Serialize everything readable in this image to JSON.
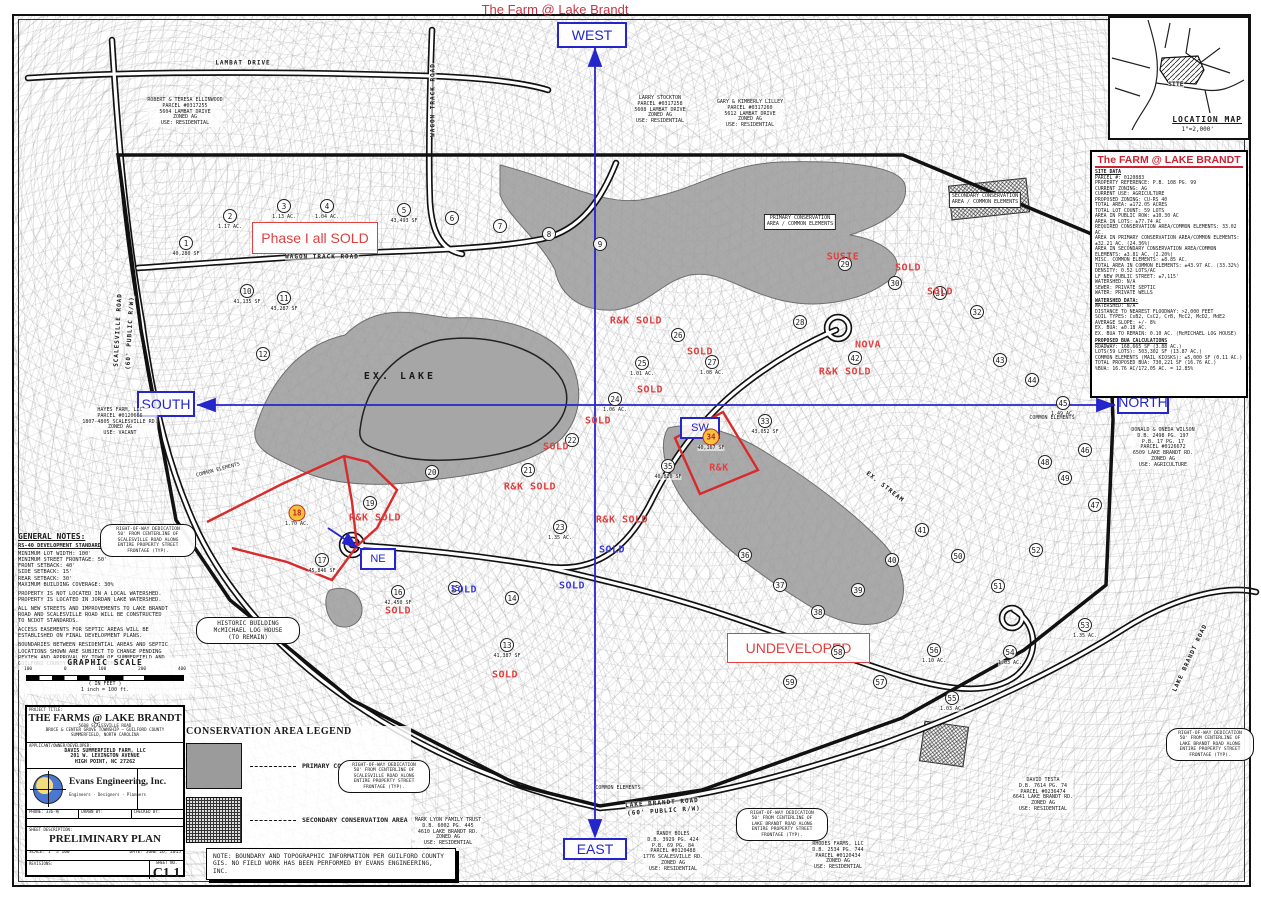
{
  "page_title": "The Farm @ Lake Brandt",
  "colors": {
    "annotation_red": "#e04040",
    "compass_blue": "#2525cc",
    "highlight_orange": "#f6c13d",
    "conservation_gray": "#9b9b9b"
  },
  "compass": {
    "west": "WEST",
    "east": "EAST",
    "south": "SOUTH",
    "north": "NORTH",
    "ne": "NE",
    "sw": "SW"
  },
  "location_map": {
    "site": "SITE",
    "title": "LOCATION MAP",
    "scale": "1\"=2,000'"
  },
  "site_data": {
    "title": "The FARM @ LAKE BRANDT",
    "lines": [
      {
        "t": "SITE DATA",
        "h": true
      },
      {
        "t": "PARCEL #: 0120883"
      },
      {
        "t": "PROPERTY REFERENCE: P.B. 108 PG. 99"
      },
      {
        "t": "CURRENT ZONING: AG"
      },
      {
        "t": "CURRENT USE: AGRICULTURE"
      },
      {
        "t": "PROPOSED ZONING: CU-RS 40"
      },
      {
        "t": "TOTAL AREA: ±172.05 ACRES"
      },
      {
        "t": "TOTAL LOT COUNT: 59 LOTS"
      },
      {
        "t": "AREA IN PUBLIC ROW: ±10.30 AC"
      },
      {
        "t": "AREA IN LOTS: ±77.74 AC"
      },
      {
        "t": "REQUIRED CONSERVATION AREA/COMMON ELEMENTS: 33.02 AC."
      },
      {
        "t": "AREA IN PRIMARY CONSERVATION AREA/COMMON ELEMENTS: ±32.21 AC. (24.36%)"
      },
      {
        "t": "AREA IN SECONDARY CONSERVATION AREA/COMMON ELEMENTS: ±3.81 AC. (2.20%)"
      },
      {
        "t": "MISC. COMMON ELEMENTS: ±8.85 AC."
      },
      {
        "t": "TOTAL AREA IN COMMON ELEMENTS: ±43.97 AC. (33.32%)"
      },
      {
        "t": "DENSITY: 0.52 LOTS/AC"
      },
      {
        "t": "LF NEW PUBLIC STREET: ±7,115'"
      },
      {
        "t": "WATERSHED: N/A"
      },
      {
        "t": "SEWER: PRIVATE SEPTIC"
      },
      {
        "t": "WATER: PRIVATE WELLS"
      },
      {
        "t": "WATERSHED DATA:",
        "h": true
      },
      {
        "t": "WATERSHED: N/A"
      },
      {
        "t": "DISTANCE TO NEAREST FLOODWAY: >2,000 FEET"
      },
      {
        "t": "SOIL TYPES: CsB2, CsC2, CrB, McC2, McD2, MdE2"
      },
      {
        "t": "AVERAGE SLOPE: +/- 8%"
      },
      {
        "t": "EX. BUA: ±0.18 AC."
      },
      {
        "t": "EX. BUA TO REMAIN: 0.10 AC. (McMICHAEL LOG HOUSE)"
      },
      {
        "t": "PROPOSED BUA CALCULATIONS",
        "h": true
      },
      {
        "t": "ROADWAY: 168,665 SF (3.88 AC.)"
      },
      {
        "t": "LOTS(59 LOTS): 503,302 SF (13.87 AC.)"
      },
      {
        "t": "COMMON ELEMENTS (MAIL KIOSKS): ±5,000 SF (0.11 AC.)"
      },
      {
        "t": "TOTAL PROPOSED BUA: 730,221 SF (16.76 AC.)"
      },
      {
        "t": "%BUA: 16.76 AC/172.05 AC. = 12.85%"
      }
    ]
  },
  "map": {
    "lake_label": "EX. LAKE",
    "phase1_label": "Phase I all SOLD",
    "undeveloped_label": "UNDEVELOPED",
    "lots": [
      {
        "n": "1",
        "x": 186,
        "y": 243,
        "a": "40,280 SF"
      },
      {
        "n": "2",
        "x": 230,
        "y": 216,
        "a": "1.17 AC."
      },
      {
        "n": "3",
        "x": 284,
        "y": 206,
        "a": "1.13 AC."
      },
      {
        "n": "4",
        "x": 327,
        "y": 206,
        "a": "1.04 AC."
      },
      {
        "n": "5",
        "x": 404,
        "y": 210,
        "a": "43,493 SF"
      },
      {
        "n": "6",
        "x": 452,
        "y": 218
      },
      {
        "n": "7",
        "x": 500,
        "y": 226
      },
      {
        "n": "8",
        "x": 549,
        "y": 234
      },
      {
        "n": "9",
        "x": 600,
        "y": 244
      },
      {
        "n": "10",
        "x": 247,
        "y": 291,
        "a": "41,135 SF"
      },
      {
        "n": "11",
        "x": 284,
        "y": 298,
        "a": "43,287 SF"
      },
      {
        "n": "12",
        "x": 263,
        "y": 354
      },
      {
        "n": "13",
        "x": 507,
        "y": 645,
        "a": "41,387 SF"
      },
      {
        "n": "14",
        "x": 512,
        "y": 598
      },
      {
        "n": "15",
        "x": 455,
        "y": 588
      },
      {
        "n": "16",
        "x": 398,
        "y": 592,
        "a": "42,450 SF"
      },
      {
        "n": "17",
        "x": 322,
        "y": 560,
        "a": "45,846 SF"
      },
      {
        "n": "18",
        "x": 297,
        "y": 513,
        "a": "1.70 AC.",
        "hl": true
      },
      {
        "n": "19",
        "x": 370,
        "y": 503
      },
      {
        "n": "20",
        "x": 432,
        "y": 472
      },
      {
        "n": "21",
        "x": 528,
        "y": 470
      },
      {
        "n": "22",
        "x": 572,
        "y": 440
      },
      {
        "n": "23",
        "x": 560,
        "y": 527,
        "a": "1.35 AC."
      },
      {
        "n": "24",
        "x": 615,
        "y": 399,
        "a": "1.06 AC."
      },
      {
        "n": "25",
        "x": 642,
        "y": 363,
        "a": "1.01 AC."
      },
      {
        "n": "26",
        "x": 678,
        "y": 335
      },
      {
        "n": "27",
        "x": 712,
        "y": 362,
        "a": "1.08 AC."
      },
      {
        "n": "28",
        "x": 800,
        "y": 322
      },
      {
        "n": "29",
        "x": 845,
        "y": 264
      },
      {
        "n": "30",
        "x": 895,
        "y": 283
      },
      {
        "n": "31",
        "x": 940,
        "y": 293
      },
      {
        "n": "32",
        "x": 977,
        "y": 312
      },
      {
        "n": "33",
        "x": 765,
        "y": 421,
        "a": "43,052 SF"
      },
      {
        "n": "34",
        "x": 711,
        "y": 437,
        "a": "40,167 SF",
        "hl": true
      },
      {
        "n": "35",
        "x": 668,
        "y": 466,
        "a": "40,820 SF"
      },
      {
        "n": "36",
        "x": 745,
        "y": 555
      },
      {
        "n": "37",
        "x": 780,
        "y": 585
      },
      {
        "n": "38",
        "x": 818,
        "y": 612
      },
      {
        "n": "39",
        "x": 858,
        "y": 590
      },
      {
        "n": "40",
        "x": 892,
        "y": 560
      },
      {
        "n": "41",
        "x": 922,
        "y": 530
      },
      {
        "n": "42",
        "x": 855,
        "y": 358
      },
      {
        "n": "43",
        "x": 1000,
        "y": 360
      },
      {
        "n": "44",
        "x": 1032,
        "y": 380
      },
      {
        "n": "45",
        "x": 1063,
        "y": 403,
        "a": "1.49 AC."
      },
      {
        "n": "46",
        "x": 1085,
        "y": 450
      },
      {
        "n": "47",
        "x": 1095,
        "y": 505
      },
      {
        "n": "48",
        "x": 1045,
        "y": 462
      },
      {
        "n": "49",
        "x": 1065,
        "y": 478
      },
      {
        "n": "50",
        "x": 958,
        "y": 556
      },
      {
        "n": "51",
        "x": 998,
        "y": 586
      },
      {
        "n": "52",
        "x": 1036,
        "y": 550
      },
      {
        "n": "53",
        "x": 1085,
        "y": 625,
        "a": "1.35 AC."
      },
      {
        "n": "54",
        "x": 1010,
        "y": 652,
        "a": "1.03 AC."
      },
      {
        "n": "55",
        "x": 952,
        "y": 698,
        "a": "1.03 AC."
      },
      {
        "n": "56",
        "x": 934,
        "y": 650,
        "a": "1.10 AC."
      },
      {
        "n": "57",
        "x": 880,
        "y": 682
      },
      {
        "n": "58",
        "x": 838,
        "y": 652
      },
      {
        "n": "59",
        "x": 790,
        "y": 682
      }
    ],
    "sold_labels": [
      {
        "t": "R&K SOLD",
        "x": 636,
        "y": 321,
        "c": "r"
      },
      {
        "t": "SOLD",
        "x": 700,
        "y": 352,
        "c": "r"
      },
      {
        "t": "SOLD",
        "x": 650,
        "y": 390,
        "c": "r"
      },
      {
        "t": "SOLD",
        "x": 598,
        "y": 421,
        "c": "r"
      },
      {
        "t": "SOLD",
        "x": 556,
        "y": 447,
        "c": "r"
      },
      {
        "t": "R&K SOLD",
        "x": 530,
        "y": 487,
        "c": "r"
      },
      {
        "t": "R&K SOLD",
        "x": 622,
        "y": 520,
        "c": "r"
      },
      {
        "t": "SOLD",
        "x": 612,
        "y": 550,
        "c": "b"
      },
      {
        "t": "R&K SOLD",
        "x": 375,
        "y": 518,
        "c": "r"
      },
      {
        "t": "SOLD",
        "x": 398,
        "y": 611,
        "c": "r"
      },
      {
        "t": "SOLD",
        "x": 464,
        "y": 590,
        "c": "b"
      },
      {
        "t": "SOLD",
        "x": 572,
        "y": 586,
        "c": "b"
      },
      {
        "t": "SOLD",
        "x": 505,
        "y": 675,
        "c": "r"
      },
      {
        "t": "SOLD",
        "x": 908,
        "y": 268,
        "c": "r"
      },
      {
        "t": "SOLD",
        "x": 940,
        "y": 292,
        "c": "r"
      },
      {
        "t": "SUSIE",
        "x": 843,
        "y": 257,
        "c": "r"
      },
      {
        "t": "NOVA",
        "x": 868,
        "y": 345,
        "c": "r"
      },
      {
        "t": "R&K SOLD",
        "x": 845,
        "y": 372,
        "c": "r"
      },
      {
        "t": "R&K",
        "x": 719,
        "y": 468,
        "c": "r"
      }
    ],
    "road_labels": [
      {
        "t": "LAMBAT DRIVE",
        "x": 243,
        "y": 63,
        "r": 0
      },
      {
        "t": "WAGON TRACK ROAD",
        "x": 433,
        "y": 100,
        "r": -90
      },
      {
        "t": "WAGON TRACK ROAD",
        "x": 322,
        "y": 257,
        "r": 0
      },
      {
        "t": "SCALESVILLE ROAD",
        "x": 118,
        "y": 330,
        "r": -87
      },
      {
        "t": "(60' PUBLIC R/W)",
        "x": 130,
        "y": 333,
        "r": -87
      },
      {
        "t": "LAKE BRANDT ROAD",
        "x": 662,
        "y": 803,
        "r": -4
      },
      {
        "t": "(60' PUBLIC R/W)",
        "x": 664,
        "y": 811,
        "r": -4
      },
      {
        "t": "LAKE BRANDT ROAD",
        "x": 1190,
        "y": 658,
        "r": -65
      },
      {
        "t": "EX. STREAM",
        "x": 885,
        "y": 487,
        "r": 38
      }
    ],
    "misc_labels": [
      {
        "t": "COMMON ELEMENTS",
        "x": 218,
        "y": 470,
        "r": -15
      },
      {
        "t": "COMMON ELEMENTS",
        "x": 1052,
        "y": 418,
        "r": 0
      },
      {
        "t": "COMMON ELEMENTS",
        "x": 618,
        "y": 788,
        "r": 0
      }
    ],
    "parcels": [
      {
        "x": 185,
        "y": 98,
        "lines": [
          "ROBERT & TERESA ELLINWOOD",
          "PARCEL #0317255",
          "5604 LAMBAT DRIVE",
          "ZONED AG",
          "USE: RESIDENTIAL"
        ]
      },
      {
        "x": 660,
        "y": 96,
        "lines": [
          "LARRY STOCKTON",
          "PARCEL #0317258",
          "5608 LAMBAT DRIVE",
          "ZONED AG",
          "USE: RESIDENTIAL"
        ]
      },
      {
        "x": 750,
        "y": 100,
        "lines": [
          "GARY & KIMBERLY LILLEY",
          "PARCEL #0317260",
          "5612 LAMBAT DRIVE",
          "ZONED AG",
          "USE: RESIDENTIAL"
        ]
      },
      {
        "x": 120,
        "y": 408,
        "lines": [
          "HAYES FARM, LLC",
          "PARCEL #0120666",
          "1807-4805 SCALESVILLE RD.",
          "ZONED AG",
          "USE: VACANT"
        ]
      },
      {
        "x": 1163,
        "y": 428,
        "lines": [
          "DONALD & ONEDA WILSON",
          "D.B. 2498 PG. 197",
          "P.B. 17 PG. 17",
          "PARCEL #0126672",
          "6509 LAKE BRANDT RD.",
          "ZONED AG",
          "USE: AGRICULTURE"
        ]
      },
      {
        "x": 673,
        "y": 832,
        "lines": [
          "RANDY BOLES",
          "D.B. 3929 PG. 424",
          "P.B. 69 PG. 84",
          "PARCEL #0120488",
          "1776 SCALESVILLE RD.",
          "ZONED AG",
          "USE: RESIDENTIAL"
        ]
      },
      {
        "x": 448,
        "y": 818,
        "lines": [
          "MARK LYON FAMILY TRUST",
          "D.B. 6002 PG. 445",
          "4610 LAKE BRANDT RD.",
          "ZONED AG",
          "USE: RESIDENTIAL"
        ]
      },
      {
        "x": 838,
        "y": 842,
        "lines": [
          "RHODES FARMS, LLC",
          "D.B. 2534 PG. 744",
          "PARCEL #0120434",
          "ZONED AG",
          "USE: RESIDENTIAL"
        ]
      },
      {
        "x": 1043,
        "y": 778,
        "lines": [
          "DAVID TESTA",
          "D.B. 7614 PG. 74",
          "PARCEL #0236474",
          "6641 LAKE BRANDT RD.",
          "ZONED AG",
          "USE: RESIDENTIAL"
        ]
      },
      {
        "x": 800,
        "y": 214,
        "boxed": true,
        "lines": [
          "PRIMARY CONSERVATION",
          "AREA / COMMON ELEMENTS"
        ]
      },
      {
        "x": 985,
        "y": 192,
        "boxed": true,
        "lines": [
          "SECONDARY CONSERVATION",
          "AREA / COMMON ELEMENTS"
        ]
      }
    ],
    "clouds": [
      {
        "x": 100,
        "y": 524,
        "w": 96,
        "lines": [
          "RIGHT-OF-WAY DEDICATION",
          "50' FROM CENTERLINE OF",
          "SCALESVILLE ROAD ALONG",
          "ENTIRE PROPERTY STREET",
          "FRONTAGE (TYP)."
        ]
      },
      {
        "x": 338,
        "y": 760,
        "w": 92,
        "lines": [
          "RIGHT-OF-WAY DEDICATION",
          "50' FROM CENTERLINE OF",
          "SCALESVILLE ROAD ALONG",
          "ENTIRE PROPERTY STREET",
          "FRONTAGE (TYP)."
        ]
      },
      {
        "x": 736,
        "y": 808,
        "w": 92,
        "lines": [
          "RIGHT-OF-WAY DEDICATION",
          "50' FROM CENTERLINE OF",
          "LAKE BRANDT ROAD ALONG",
          "ENTIRE PROPERTY STREET",
          "FRONTAGE (TYP)."
        ]
      },
      {
        "x": 1166,
        "y": 728,
        "w": 88,
        "lines": [
          "RIGHT-OF-WAY DEDICATION",
          "50' FROM CENTERLINE OF",
          "LAKE BRANDT ROAD ALONG",
          "ENTIRE PROPERTY STREET",
          "FRONTAGE (TYP)."
        ]
      },
      {
        "x": 196,
        "y": 617,
        "w": 104,
        "big": true,
        "lines": [
          "HISTORIC BUILDING",
          "McMICHAEL LOG HOUSE",
          "(TO REMAIN)"
        ]
      }
    ]
  },
  "general_notes": {
    "heading": "GENERAL NOTES:",
    "subheading": "RS-40 DEVELOPMENT STANDARDS:",
    "standards": [
      "MINIMUM LOT WIDTH: 100'",
      "MINIMUM STREET FRONTAGE: 50'",
      "FRONT SETBACK: 40'",
      "SIDE SETBACK: 15'",
      "REAR SETBACK: 30'",
      "MAXIMUM BUILDING COVERAGE: 30%"
    ],
    "paragraphs": [
      "PROPERTY IS NOT LOCATED IN A LOCAL WATERSHED. PROPERTY IS LOCATED IN JORDAN LAKE WATERSHED.",
      "ALL NEW STREETS AND IMPROVEMENTS TO LAKE BRANDT ROAD AND SCALESVILLE ROAD WILL BE CONSTRUCTED TO NCDOT STANDARDS.",
      "ACCESS EASEMENTS FOR SEPTIC AREAS WILL BE ESTABLISHED ON FINAL DEVELOPMENT PLANS.",
      "BOUNDARIES BETWEEN RESIDENTIAL AREAS AND SEPTIC LOCATIONS SHOWN ARE SUBJECT TO CHANGE PENDING REVIEW AND APPROVAL BY TOWN OF SUMMERFIELD AND GUILFORD COUNTY HEALTH DEPARTMENT."
    ]
  },
  "graphic_scale": {
    "title": "GRAPHIC SCALE",
    "ticks": [
      "100",
      "0",
      "100",
      "200",
      "400"
    ],
    "units": "( IN FEET )",
    "ratio": "1 inch = 100 ft."
  },
  "legend": {
    "title": "CONSERVATION AREA LEGEND",
    "items": [
      {
        "label": "PRIMARY CONSERVATION AREA"
      },
      {
        "label": "SECONDARY CONSERVATION AREA"
      }
    ]
  },
  "note_box": "NOTE: BOUNDARY AND TOPOGRAPHIC INFORMATION PER GUILFORD COUNTY GIS. NO FIELD WORK HAS BEEN PERFORMED BY EVANS ENGINEERING, INC.",
  "title_block": {
    "project_label": "PROJECT TITLE:",
    "project_title": "THE FARMS @ LAKE BRANDT",
    "project_address": [
      "5608 SCALESVILLE ROAD",
      "BRUCE & CENTER GROVE TOWNSHIP — GUILFORD COUNTY",
      "SUMMERFIELD, NORTH CAROLINA"
    ],
    "applicant_label": "APPLICANT/OWNER/DEVELOPER:",
    "applicant_lines": [
      "DAVIS SUMMERFIELD FARM, LLC",
      "201 W. LEXINGTON AVENUE",
      "HIGH POINT, NC 27262"
    ],
    "firm_name": "Evans Engineering, Inc.",
    "firm_tagline": "Engineers · Designers · Planners",
    "info_cells": [
      "PHONE: 336-布",
      "DRAWN BY:",
      "CHECKED BY:"
    ],
    "sheet_desc_label": "SHEET DESCRIPTION:",
    "sheet_description": "PRELIMINARY PLAN",
    "scale": "SCALE:  1\" = 100'",
    "date": "DATE:  JUNE 26, 2015",
    "revisions_label": "REVISIONS:",
    "sheet_no_label": "SHEET NO.",
    "sheet_no": "C1.1"
  }
}
